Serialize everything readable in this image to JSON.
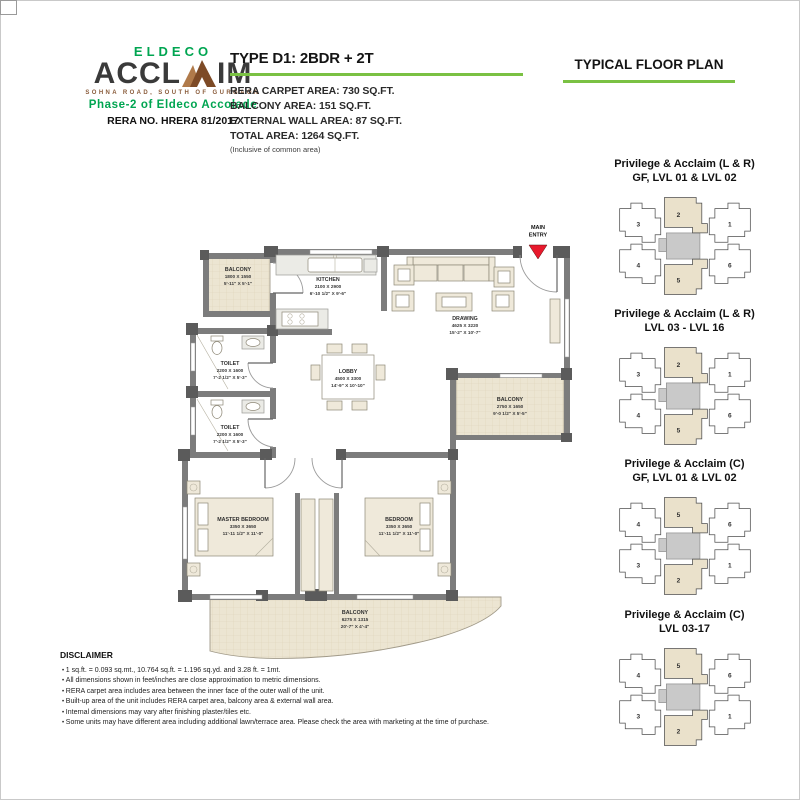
{
  "colors": {
    "brand_green": "#00a551",
    "brand_brown": "#8a5c3b",
    "accent_underline": "#7ac143",
    "entry_arrow_red": "#e8192c",
    "wall_gray": "#7c7c7c",
    "balcony_beige": "#ece5d2"
  },
  "brand": {
    "eldeco": "ELDECO",
    "acclaim_left": "ACCL",
    "acclaim_right": "IM",
    "tagline": "SOHNA ROAD, SOUTH OF GURGAON",
    "phase": "Phase-2 of Eldeco Accolade",
    "rera": "RERA NO. HRERA 81/2017"
  },
  "header": {
    "type_title": "TYPE D1: 2BDR + 2T",
    "areas": [
      "RERA CARPET AREA: 730 SQ.FT.",
      "BALCONY AREA: 151 SQ.FT.",
      "EXTERNAL WALL AREA: 87 SQ.FT.",
      "TOTAL AREA: 1264 SQ.FT."
    ],
    "inclusive_note": "(Inclusive of common area)",
    "plan_title": "TYPICAL FLOOR PLAN"
  },
  "floorplan": {
    "entry": {
      "line1": "MAIN",
      "line2": "ENTRY"
    },
    "rooms": {
      "balcony_tl": {
        "name": "BALCONY",
        "metric": "1800 X 1550",
        "imperial": "5'-11\" X 5'-1\""
      },
      "kitchen": {
        "name": "KITCHEN",
        "metric": "2100 X 2900",
        "imperial": "6'-10 1/2\" X 9'-6\""
      },
      "drawing": {
        "name": "DRAWING",
        "metric": "4625 X 3220",
        "imperial": "15'-2\" X 10'-7\""
      },
      "lobby": {
        "name": "LOBBY",
        "metric": "4500 X 3300",
        "imperial": "14'-9\" X 10'-10\""
      },
      "toilet1": {
        "name": "TOILET",
        "metric": "2200 X 1600",
        "imperial": "7'-2 1/2\" X 5'-3\""
      },
      "toilet2": {
        "name": "TOILET",
        "metric": "2200 X 1600",
        "imperial": "7'-2 1/2\" X 5'-3\""
      },
      "balcony_r": {
        "name": "BALCONY",
        "metric": "2750 X 1650",
        "imperial": "9'-0 1/2\" X 5'-5\""
      },
      "master": {
        "name": "MASTER BEDROOM",
        "metric": "3350 X 3650",
        "imperial": "11'-11 1/2\" X 11'-0\""
      },
      "bedroom": {
        "name": "BEDROOM",
        "metric": "3350 X 3650",
        "imperial": "11'-11 1/2\" X 11'-0\""
      },
      "balcony_b": {
        "name": "BALCONY",
        "metric": "6275 X 1315",
        "imperial": "20'-7\" X 4'-4\""
      }
    }
  },
  "keyplans": [
    {
      "title1": "Privilege & Acclaim (L & R)",
      "title2": "GF, LVL 01 & LVL 02",
      "units": {
        "tl": "3",
        "tc": "2",
        "tr": "1",
        "bl": "4",
        "bc": "5",
        "br": "6"
      }
    },
    {
      "title1": "Privilege & Acclaim (L & R)",
      "title2": "LVL 03 - LVL 16",
      "units": {
        "tl": "3",
        "tc": "2",
        "tr": "1",
        "bl": "4",
        "bc": "5",
        "br": "6"
      }
    },
    {
      "title1": "Privilege & Acclaim (C)",
      "title2": "GF, LVL 01 & LVL 02",
      "units": {
        "tl": "4",
        "tc": "5",
        "tr": "6",
        "bl": "3",
        "bc": "2",
        "br": "1"
      }
    },
    {
      "title1": "Privilege & Acclaim (C)",
      "title2": "LVL 03-17",
      "units": {
        "tl": "4",
        "tc": "5",
        "tr": "6",
        "bl": "3",
        "bc": "2",
        "br": "1"
      }
    }
  ],
  "disclaimer": {
    "title": "DISCLAIMER",
    "items": [
      "1 sq.ft. = 0.093 sq.mt., 10.764 sq.ft. = 1.196 sq.yd. and 3.28 ft. = 1mt.",
      "All dimensions shown in feet/inches are close approximation to metric dimensions.",
      "RERA carpet area includes area between the inner face of the outer wall of the unit.",
      "Built-up area of the unit includes RERA carpet area, balcony area & external wall area.",
      "Internal dimensions may vary after finishing plaster/tiles etc.",
      "Some units may have different area including additional lawn/terrace area. Please check the area with marketing at the time of purchase."
    ]
  }
}
